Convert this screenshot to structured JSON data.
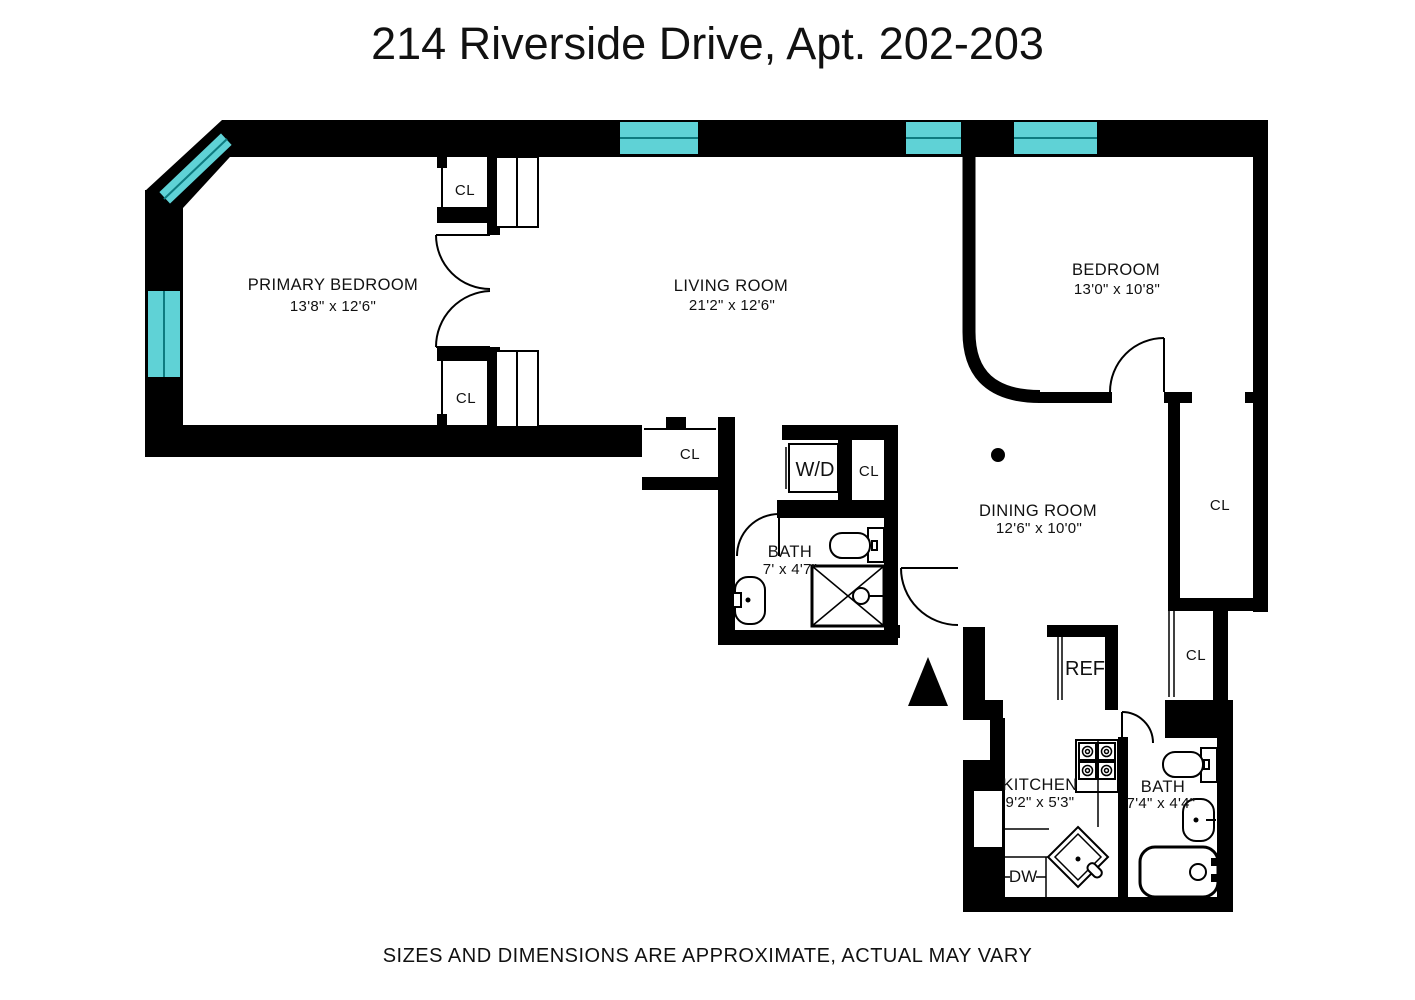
{
  "title": "214 Riverside Drive, Apt. 202-203",
  "disclaimer": "SIZES AND DIMENSIONS ARE APPROXIMATE, ACTUAL MAY VARY",
  "colors": {
    "wall": "#000000",
    "window_glass": "#5fd2d6",
    "window_mullion": "#0e7b80"
  },
  "rooms": {
    "primary_bedroom": {
      "name": "PRIMARY BEDROOM",
      "dims": "13'8\" x 12'6\""
    },
    "living_room": {
      "name": "LIVING ROOM",
      "dims": "21'2\" x 12'6\""
    },
    "bedroom": {
      "name": "BEDROOM",
      "dims": "13'0\" x 10'8\""
    },
    "dining_room": {
      "name": "DINING ROOM",
      "dims": "12'6\" x 10'0\""
    },
    "bath_main": {
      "name": "BATH",
      "dims": "7' x 4'7\""
    },
    "bath_second": {
      "name": "BATH",
      "dims": "7'4\" x 4'4\""
    },
    "kitchen": {
      "name": "KITCHEN",
      "dims": "9'2\" x 5'3\""
    }
  },
  "fixtures": {
    "closet": "CL",
    "washer_dryer": "W/D",
    "refrigerator": "REF",
    "dishwasher": "DW"
  }
}
